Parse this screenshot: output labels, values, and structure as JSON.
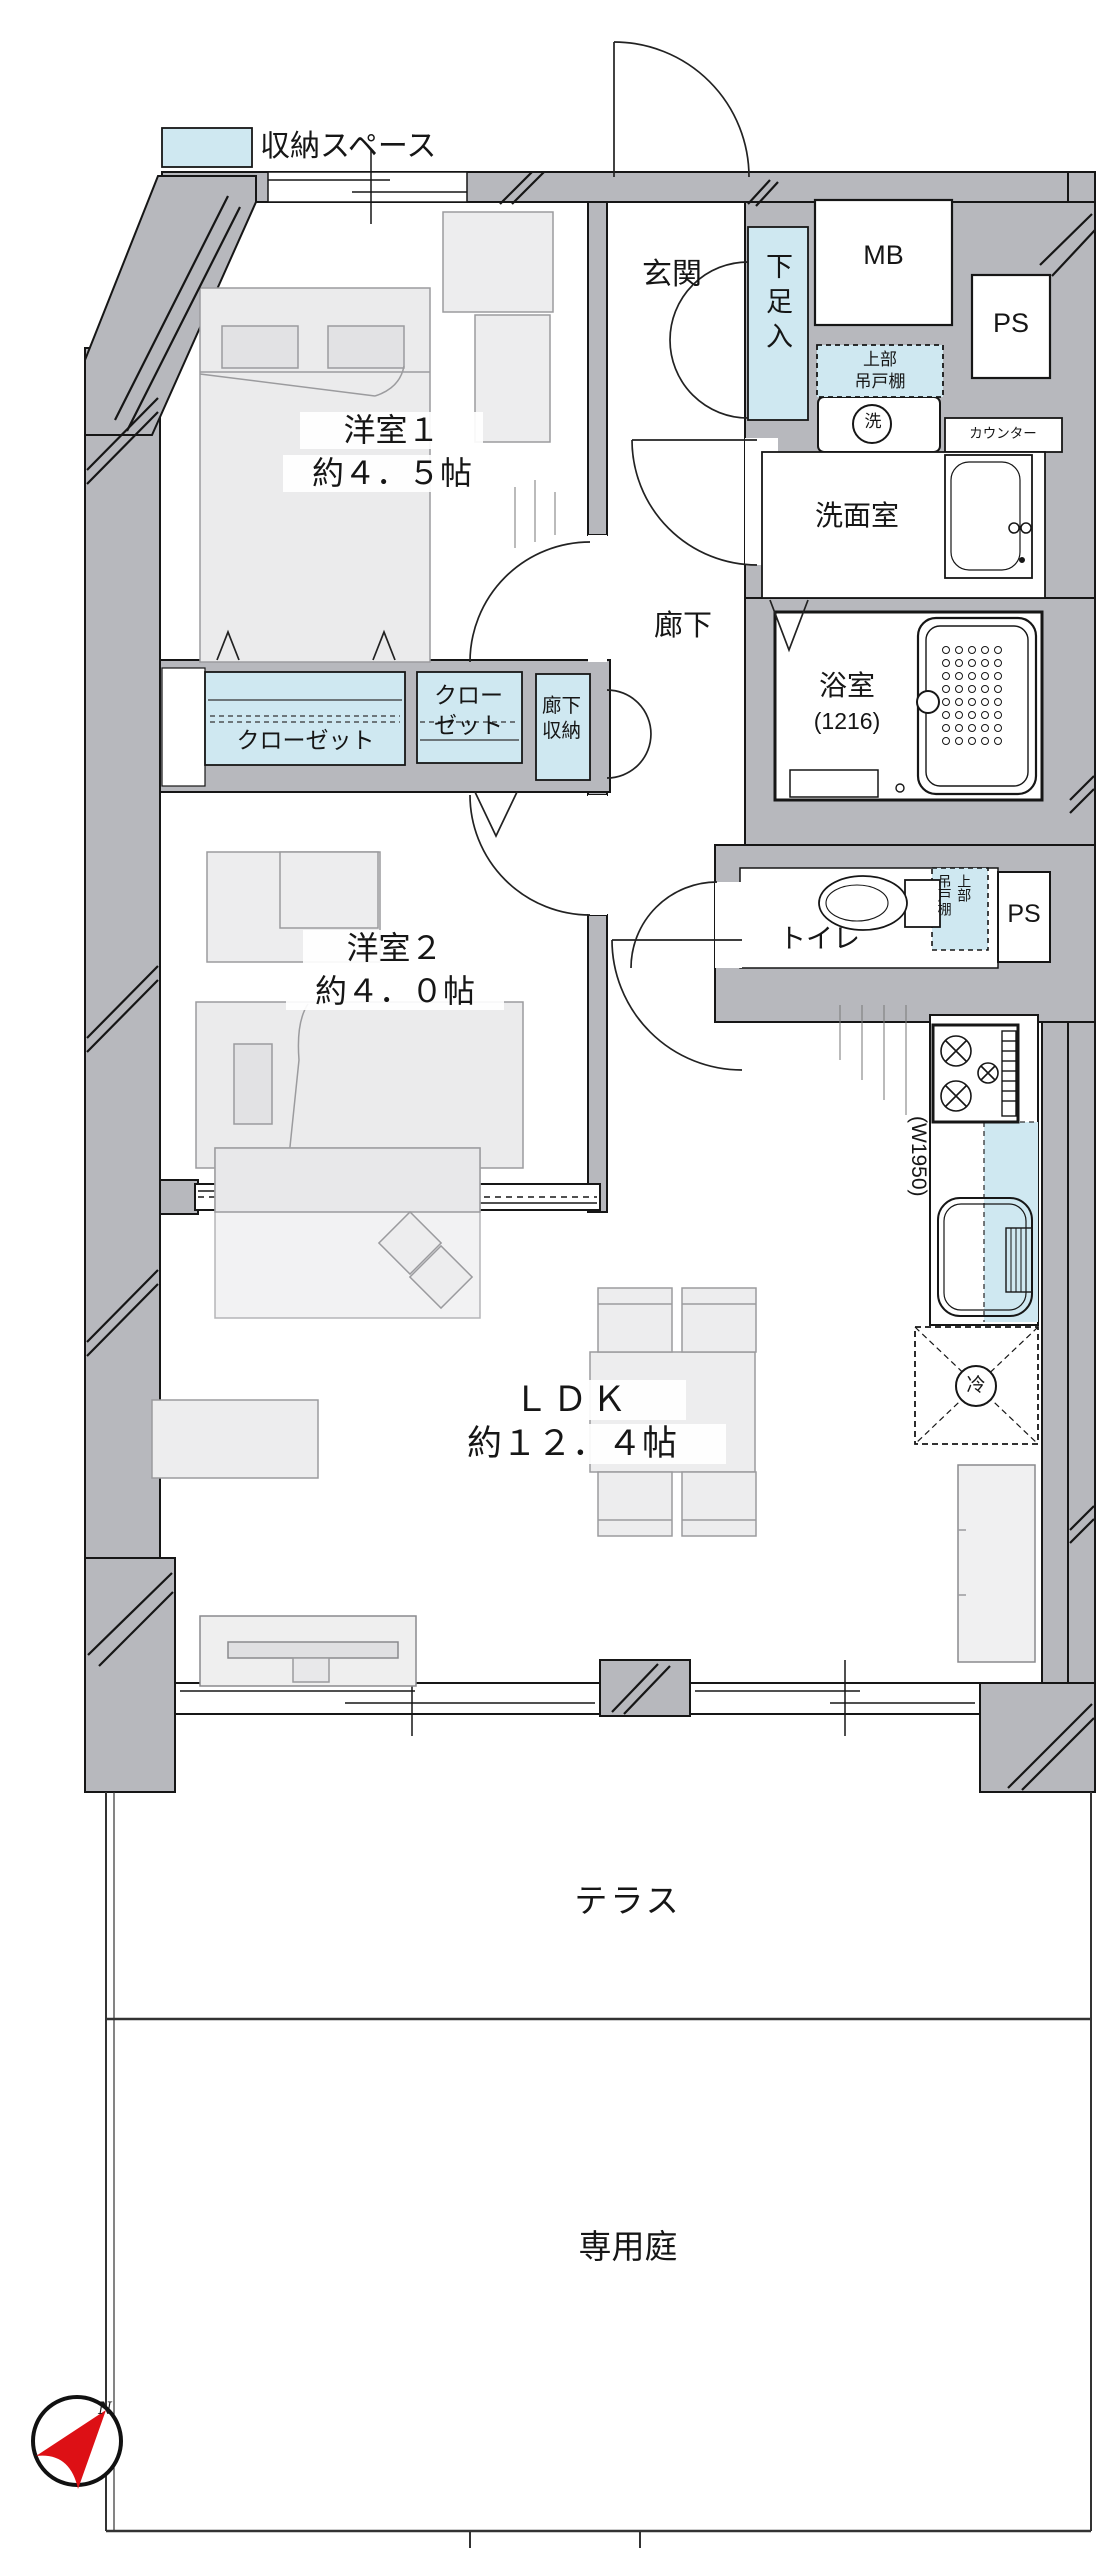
{
  "colors": {
    "wall_gray": "#b7b8bd",
    "storage_blue": "#cfe8f1",
    "compass_red": "#dd1015",
    "line_dark": "#161616"
  },
  "legend": {
    "label": "収納スペース"
  },
  "labels": {
    "genkan": "玄関",
    "shoe_cabinet": "下足入",
    "meter_box": "MB",
    "pipe_space_top": "PS",
    "upper_cabinet_1": "上部",
    "upper_cabinet_2": "吊戸棚",
    "washer": "洗",
    "counter": "カウンター",
    "washroom": "洗面室",
    "bath": "浴室",
    "bath_size": "(1216)",
    "room1": "洋室１",
    "room1_size": "約４．５帖",
    "hallway": "廊下",
    "closet1": "クローゼット",
    "closet2_1": "クロー",
    "closet2_2": "ゼット",
    "hall_storage_1": "廊下",
    "hall_storage_2": "収納",
    "room2": "洋室２",
    "room2_size": "約４．０帖",
    "toilet": "トイレ",
    "toilet_cabinet_1": "上部",
    "toilet_cabinet_2": "吊戸棚",
    "pipe_space_bottom": "PS",
    "kitchen_width": "(W1950)",
    "fridge": "冷",
    "ldk": "ＬＤＫ",
    "ldk_size": "約１２．４帖",
    "terrace": "テラス",
    "garden": "専用庭",
    "compass_north": "N"
  }
}
